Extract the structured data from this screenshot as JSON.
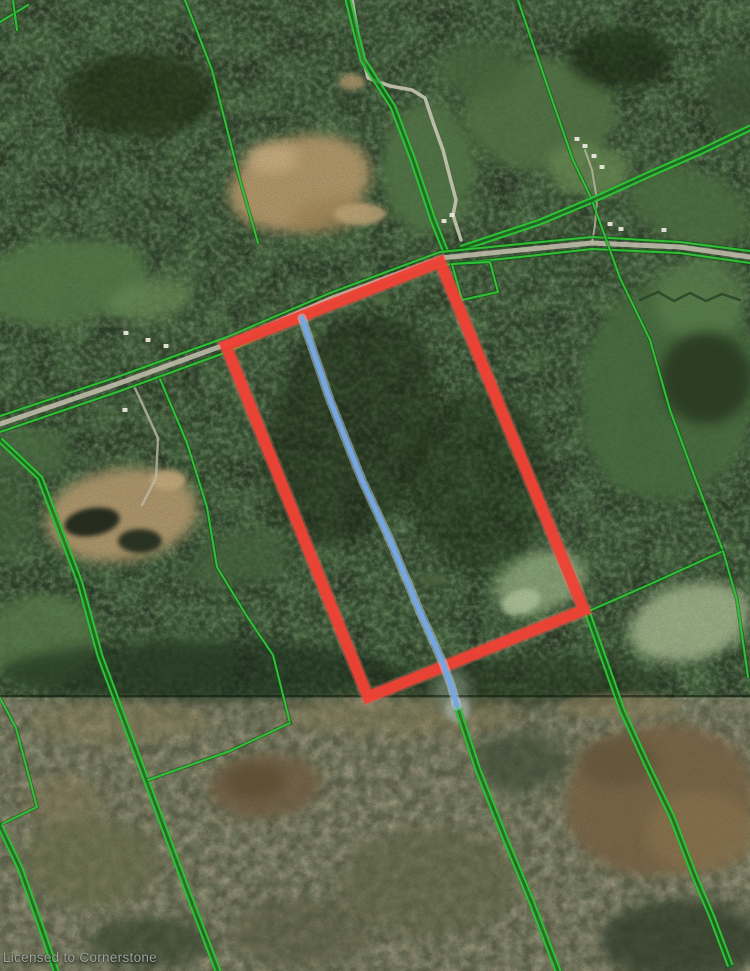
{
  "map": {
    "watermark": "Licensed to Cornerstone",
    "colors": {
      "parcel_highlight": "#ef4135",
      "parcel_glow": "#f4786b",
      "boundary_green": "#2fc235",
      "boundary_green_dark": "#176b20",
      "trail_blue": "#74a7e3",
      "trail_blue_halo": "#cfe0f2",
      "road_gray": "#c6c1b0",
      "forest_base": "#2a3a26",
      "lowland_base": "#5f624a"
    },
    "highlight_parcel": {
      "stroke_width": 11,
      "points": [
        [
          440,
          262
        ],
        [
          226,
          346
        ],
        [
          368,
          697
        ],
        [
          584,
          610
        ]
      ]
    },
    "blue_line": {
      "width": 5,
      "points": [
        [
          302,
          318
        ],
        [
          330,
          400
        ],
        [
          362,
          480
        ],
        [
          390,
          540
        ],
        [
          420,
          612
        ],
        [
          443,
          663
        ],
        [
          451,
          685
        ],
        [
          457,
          706
        ]
      ]
    },
    "green_lines": [
      {
        "name": "boundary-topleft-diagonal",
        "double": false,
        "points": [
          [
            185,
            0
          ],
          [
            212,
            70
          ],
          [
            240,
            180
          ],
          [
            258,
            243
          ]
        ]
      },
      {
        "name": "boundary-north-pair",
        "double": true,
        "points": [
          [
            348,
            0
          ],
          [
            363,
            60
          ],
          [
            393,
            107
          ],
          [
            413,
            160
          ],
          [
            433,
            220
          ],
          [
            445,
            250
          ]
        ]
      },
      {
        "name": "boundary-north-single",
        "double": false,
        "points": [
          [
            518,
            0
          ],
          [
            547,
            85
          ],
          [
            573,
            160
          ],
          [
            592,
            200
          ]
        ]
      },
      {
        "name": "boundary-northeast-pair",
        "double": true,
        "points": [
          [
            750,
            128
          ],
          [
            700,
            152
          ],
          [
            650,
            174
          ],
          [
            595,
            199
          ],
          [
            540,
            222
          ],
          [
            492,
            238
          ],
          [
            462,
            248
          ]
        ]
      },
      {
        "name": "road-edge-north",
        "double": false,
        "points": [
          [
            0,
            416
          ],
          [
            120,
            376
          ],
          [
            227,
            337
          ],
          [
            330,
            293
          ],
          [
            440,
            252
          ],
          [
            520,
            244
          ],
          [
            592,
            237
          ],
          [
            680,
            242
          ],
          [
            750,
            251
          ]
        ]
      },
      {
        "name": "road-edge-south",
        "double": false,
        "points": [
          [
            0,
            432
          ],
          [
            120,
            391
          ],
          [
            227,
            352
          ],
          [
            330,
            307
          ],
          [
            443,
            265
          ],
          [
            520,
            257
          ],
          [
            592,
            249
          ],
          [
            680,
            253
          ],
          [
            750,
            263
          ]
        ]
      },
      {
        "name": "boundary-east-diagonal",
        "double": false,
        "points": [
          [
            593,
            203
          ],
          [
            620,
            278
          ],
          [
            650,
            340
          ],
          [
            670,
            410
          ],
          [
            692,
            470
          ],
          [
            723,
            551
          ]
        ]
      },
      {
        "name": "boundary-to-right-corner",
        "double": false,
        "points": [
          [
            723,
            551
          ],
          [
            655,
            582
          ],
          [
            589,
            611
          ]
        ]
      },
      {
        "name": "boundary-east-edge",
        "double": false,
        "points": [
          [
            723,
            551
          ],
          [
            737,
            600
          ],
          [
            748,
            677
          ]
        ]
      },
      {
        "name": "boundary-southeast-pair",
        "double": true,
        "points": [
          [
            588,
            614
          ],
          [
            622,
            710
          ],
          [
            648,
            767
          ],
          [
            672,
            817
          ],
          [
            695,
            877
          ],
          [
            712,
            917
          ],
          [
            730,
            965
          ]
        ]
      },
      {
        "name": "boundary-west-pair",
        "double": true,
        "points": [
          [
            0,
            440
          ],
          [
            40,
            478
          ],
          [
            80,
            583
          ],
          [
            100,
            656
          ],
          [
            150,
            790
          ],
          [
            190,
            898
          ],
          [
            218,
            971
          ]
        ]
      },
      {
        "name": "boundary-mid-branch",
        "double": false,
        "points": [
          [
            160,
            379
          ],
          [
            187,
            443
          ],
          [
            207,
            507
          ],
          [
            217,
            567
          ],
          [
            248,
            618
          ],
          [
            273,
            655
          ],
          [
            290,
            723
          ]
        ]
      },
      {
        "name": "boundary-mid-horizontal",
        "double": false,
        "points": [
          [
            148,
            780
          ],
          [
            230,
            751
          ],
          [
            290,
            723
          ]
        ]
      },
      {
        "name": "parcel-small-quad",
        "double": false,
        "points": [
          [
            452,
            264
          ],
          [
            490,
            262
          ],
          [
            498,
            292
          ],
          [
            462,
            300
          ],
          [
            452,
            264
          ]
        ]
      },
      {
        "name": "boundary-south-pair",
        "double": true,
        "points": [
          [
            457,
            706
          ],
          [
            478,
            770
          ],
          [
            505,
            838
          ],
          [
            532,
            903
          ],
          [
            558,
            971
          ]
        ]
      },
      {
        "name": "boundary-southwest-L",
        "double": false,
        "points": [
          [
            0,
            698
          ],
          [
            16,
            728
          ],
          [
            37,
            807
          ],
          [
            2,
            824
          ]
        ]
      },
      {
        "name": "boundary-southwest-pair",
        "double": true,
        "points": [
          [
            0,
            826
          ],
          [
            20,
            868
          ],
          [
            42,
            930
          ],
          [
            56,
            971
          ]
        ]
      },
      {
        "name": "corner-topleft-a",
        "double": false,
        "points": [
          [
            0,
            22
          ],
          [
            28,
            5
          ]
        ]
      },
      {
        "name": "corner-topleft-b",
        "double": false,
        "points": [
          [
            13,
            0
          ],
          [
            17,
            30
          ]
        ]
      }
    ],
    "roads": [
      {
        "name": "winding-north-road",
        "width": 3.5,
        "color": "#c9c4b4",
        "opacity": 0.9,
        "points": [
          [
            352,
            0
          ],
          [
            360,
            45
          ],
          [
            368,
            78
          ],
          [
            390,
            86
          ],
          [
            412,
            90
          ],
          [
            425,
            98
          ],
          [
            434,
            125
          ],
          [
            443,
            150
          ],
          [
            452,
            185
          ],
          [
            456,
            200
          ],
          [
            453,
            215
          ],
          [
            461,
            240
          ]
        ]
      },
      {
        "name": "main-east-west-road",
        "width": 5,
        "color": "#c6c1b0",
        "opacity": 0.85,
        "points": [
          [
            0,
            424
          ],
          [
            120,
            383
          ],
          [
            227,
            344
          ],
          [
            330,
            299
          ],
          [
            441,
            258
          ],
          [
            520,
            250
          ],
          [
            592,
            243
          ],
          [
            680,
            247
          ],
          [
            750,
            257
          ]
        ]
      },
      {
        "name": "gravel-pit-driveway",
        "width": 2.5,
        "color": "#bdb8a6",
        "opacity": 0.8,
        "points": [
          [
            135,
            388
          ],
          [
            158,
            438
          ],
          [
            156,
            478
          ],
          [
            142,
            505
          ]
        ]
      },
      {
        "name": "farm-driveway",
        "width": 2,
        "color": "#bdb8a6",
        "opacity": 0.8,
        "points": [
          [
            585,
            150
          ],
          [
            592,
            170
          ],
          [
            597,
            200
          ],
          [
            595,
            225
          ],
          [
            592,
            243
          ]
        ]
      },
      {
        "name": "stream",
        "width": 2.5,
        "color": "#2c3e26",
        "opacity": 0.8,
        "points": [
          [
            640,
            300
          ],
          [
            658,
            292
          ],
          [
            674,
            301
          ],
          [
            690,
            293
          ],
          [
            706,
            301
          ],
          [
            722,
            294
          ],
          [
            740,
            300
          ]
        ]
      }
    ],
    "buildings": [
      [
        585,
        146
      ],
      [
        594,
        156
      ],
      [
        602,
        167
      ],
      [
        577,
        139
      ],
      [
        610,
        224
      ],
      [
        621,
        229
      ],
      [
        664,
        230
      ],
      [
        126,
        333
      ],
      [
        148,
        340
      ],
      [
        166,
        346
      ],
      [
        452,
        215
      ],
      [
        444,
        221
      ],
      [
        125,
        410
      ]
    ],
    "terrain": {
      "base": [
        {
          "name": "forest-upper",
          "x": 0,
          "y": 0,
          "w": 750,
          "h": 700,
          "fill": "#2a3a26"
        },
        {
          "name": "lowland-lower",
          "x": 0,
          "y": 697,
          "w": 750,
          "h": 274,
          "fill": "#5f624a"
        }
      ],
      "patches": [
        [
          300,
          183,
          72,
          46,
          -15,
          "#b89c6e",
          0.95
        ],
        [
          330,
          215,
          40,
          16,
          -10,
          "#a3885a",
          0.8
        ],
        [
          272,
          158,
          26,
          15,
          0,
          "#cbb083",
          0.9
        ],
        [
          360,
          214,
          26,
          11,
          0,
          "#c3a97c",
          0.85
        ],
        [
          352,
          82,
          13,
          8,
          0,
          "#b79b6f",
          0.8
        ],
        [
          540,
          115,
          75,
          55,
          0,
          "#547647",
          0.9
        ],
        [
          588,
          170,
          42,
          26,
          10,
          "#6b8d55",
          0.8
        ],
        [
          480,
          70,
          40,
          28,
          0,
          "#4a6b3f",
          0.8
        ],
        [
          690,
          207,
          62,
          36,
          18,
          "#4f7345",
          0.85
        ],
        [
          737,
          95,
          30,
          42,
          0,
          "#3c5434",
          0.7
        ],
        [
          62,
          282,
          88,
          42,
          -8,
          "#567c4a",
          0.9
        ],
        [
          150,
          300,
          42,
          20,
          -10,
          "#6b8e58",
          0.8
        ],
        [
          428,
          168,
          46,
          66,
          0,
          "#54784a",
          0.9
        ],
        [
          122,
          515,
          76,
          46,
          -8,
          "#b49b6f",
          0.95
        ],
        [
          92,
          522,
          28,
          14,
          -10,
          "#232b1e",
          0.95
        ],
        [
          140,
          541,
          22,
          12,
          0,
          "#283122",
          0.95
        ],
        [
          168,
          480,
          18,
          10,
          0,
          "#c8ae80",
          0.9
        ],
        [
          240,
          560,
          52,
          28,
          -10,
          "#4a6740",
          0.7
        ],
        [
          668,
          390,
          88,
          112,
          10,
          "#4c7042",
          0.9
        ],
        [
          700,
          300,
          46,
          40,
          0,
          "#5d8350",
          0.8
        ],
        [
          706,
          378,
          46,
          46,
          0,
          "#2a3b24",
          0.85
        ],
        [
          690,
          622,
          62,
          38,
          -15,
          "#a8bc92",
          0.85
        ],
        [
          540,
          582,
          46,
          30,
          -20,
          "#97b183",
          0.8
        ],
        [
          521,
          602,
          20,
          12,
          -20,
          "#b5c9a0",
          0.8
        ],
        [
          42,
          640,
          56,
          46,
          0,
          "#5a7d4c",
          0.8
        ],
        [
          185,
          660,
          52,
          28,
          0,
          "#486841",
          0.6
        ],
        [
          30,
          452,
          40,
          25,
          0,
          "#4e7044",
          0.7
        ],
        [
          8,
          520,
          25,
          42,
          0,
          "#47663d",
          0.6
        ],
        [
          320,
          362,
          14,
          8,
          0,
          "#4f6b42",
          0.8
        ],
        [
          382,
          300,
          10,
          6,
          0,
          "#587547",
          0.8
        ],
        [
          432,
          580,
          12,
          7,
          0,
          "#50663f",
          0.8
        ],
        [
          300,
          482,
          9,
          6,
          0,
          "#4a6540",
          0.8
        ],
        [
          140,
          95,
          75,
          42,
          0,
          "#203018",
          0.7
        ],
        [
          620,
          58,
          52,
          30,
          0,
          "#1d2d19",
          0.7
        ],
        [
          350,
          430,
          80,
          120,
          20,
          "#1c2b18",
          0.5
        ],
        [
          480,
          480,
          70,
          90,
          0,
          "#1e2d19",
          0.45
        ],
        [
          200,
          672,
          200,
          30,
          0,
          "#1f2e1b",
          0.6
        ],
        [
          520,
          682,
          150,
          25,
          0,
          "#20301c",
          0.5
        ],
        [
          120,
          722,
          90,
          20,
          0,
          "#8a815c",
          0.55
        ],
        [
          400,
          716,
          120,
          18,
          0,
          "#877e58",
          0.5
        ],
        [
          620,
          706,
          60,
          14,
          0,
          "#93855f",
          0.5
        ],
        [
          660,
          800,
          95,
          75,
          -10,
          "#7b684a",
          0.95
        ],
        [
          700,
          832,
          55,
          40,
          0,
          "#8a7550",
          0.9
        ],
        [
          618,
          762,
          40,
          25,
          0,
          "#6b5b40",
          0.85
        ],
        [
          265,
          786,
          56,
          32,
          -5,
          "#746448",
          0.9
        ],
        [
          255,
          781,
          30,
          18,
          0,
          "#635538",
          0.9
        ],
        [
          90,
          862,
          70,
          45,
          0,
          "#6c6f4e",
          0.7
        ],
        [
          430,
          882,
          90,
          55,
          0,
          "#646849",
          0.6
        ],
        [
          300,
          932,
          70,
          35,
          0,
          "#5d6144",
          0.6
        ],
        [
          62,
          800,
          40,
          25,
          0,
          "#837a58",
          0.6
        ],
        [
          680,
          940,
          80,
          40,
          0,
          "#34432e",
          0.8
        ],
        [
          150,
          942,
          60,
          25,
          0,
          "#3a4832",
          0.7
        ],
        [
          520,
          762,
          46,
          30,
          0,
          "#42513a",
          0.7
        ],
        [
          452,
          692,
          18,
          22,
          0,
          "#8fa08f",
          0.6
        ],
        [
          458,
          710,
          12,
          13,
          0,
          "#b9c4c2",
          0.55
        ]
      ]
    }
  }
}
